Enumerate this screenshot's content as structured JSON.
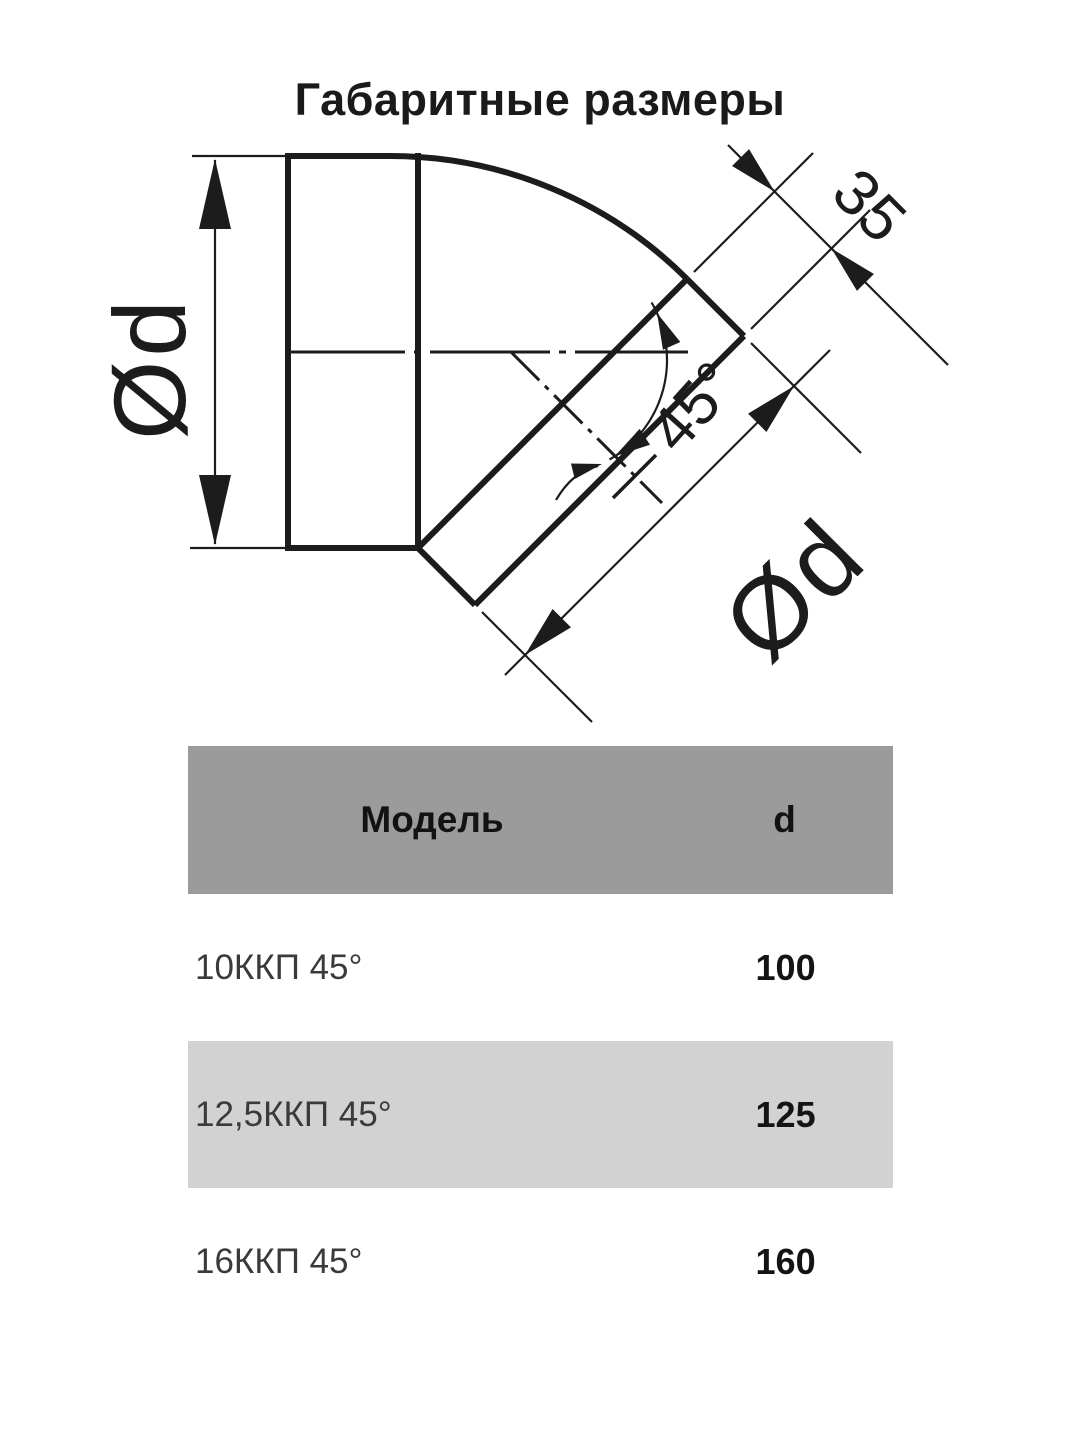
{
  "title": "Габаритные размеры",
  "drawing": {
    "left_diameter_label": "Ød",
    "outlet_diameter_label": "Ød",
    "straight_length_label": "35",
    "angle_label": "45°",
    "line_color": "#1c1c1c"
  },
  "table": {
    "header": {
      "model": "Модель",
      "d": "d"
    },
    "rows": [
      {
        "model": "10ККП 45°",
        "d": "100"
      },
      {
        "model": "12,5ККП 45°",
        "d": "125"
      },
      {
        "model": "16ККП 45°",
        "d": "160"
      }
    ],
    "colors": {
      "header_bg": "#9b9b9b",
      "alt_row_bg": "#d2d2d2"
    }
  }
}
